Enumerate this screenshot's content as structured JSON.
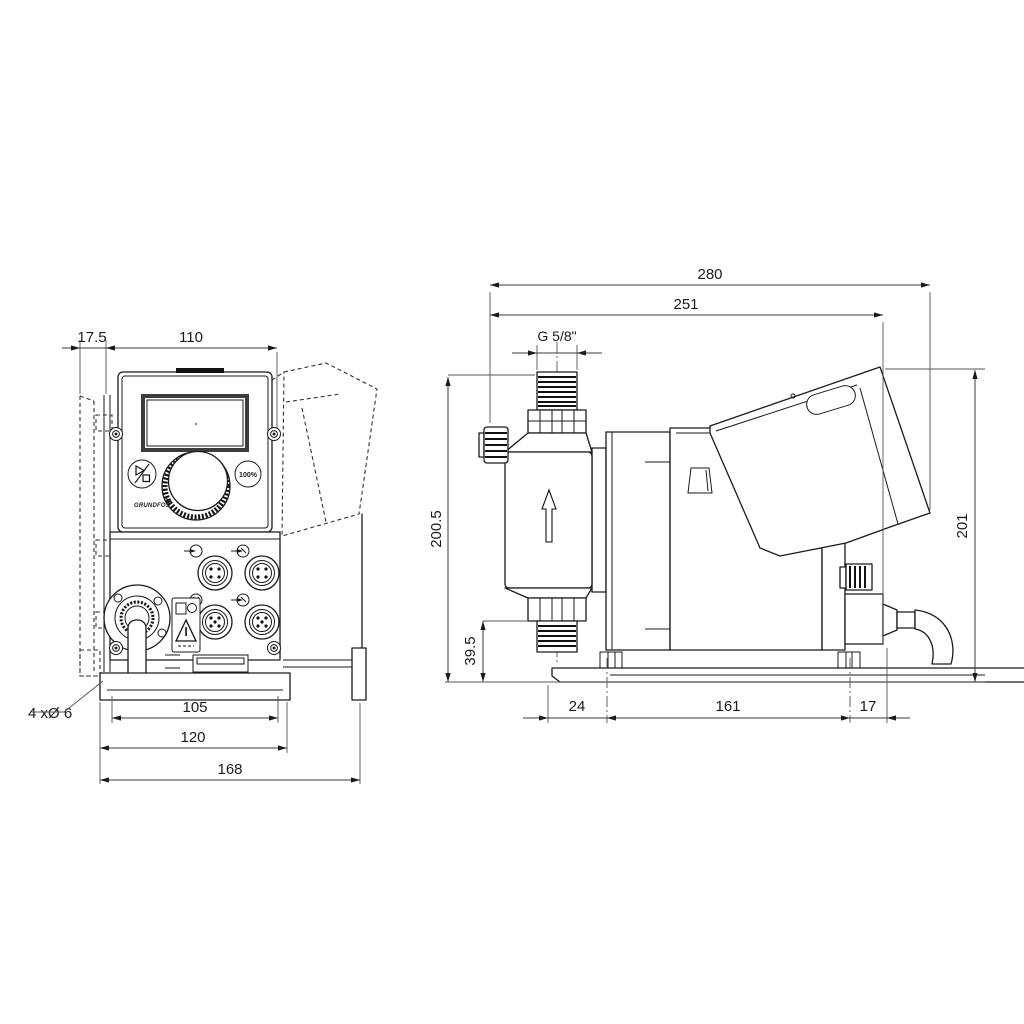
{
  "title": "Dosing pump dimensional drawing",
  "front_view": {
    "dims": {
      "wall_offset": "17.5",
      "panel_width": "110",
      "hole_spacing": "105",
      "plate_width": "120",
      "overall_width": "168",
      "mounting_holes": "4 xØ 6"
    },
    "panel": {
      "percent_button": "100%",
      "logo": "GRUNDFOS"
    }
  },
  "side_view": {
    "dims": {
      "overall_depth": "280",
      "depth_to_rear_panel": "251",
      "connection_thread": "G 5/8\"",
      "height_to_connection": "200.5",
      "valve_height": "39.5",
      "plate_front_offset": "24",
      "foot_spacing": "161",
      "rear_offset": "17",
      "overall_height": "201"
    }
  }
}
